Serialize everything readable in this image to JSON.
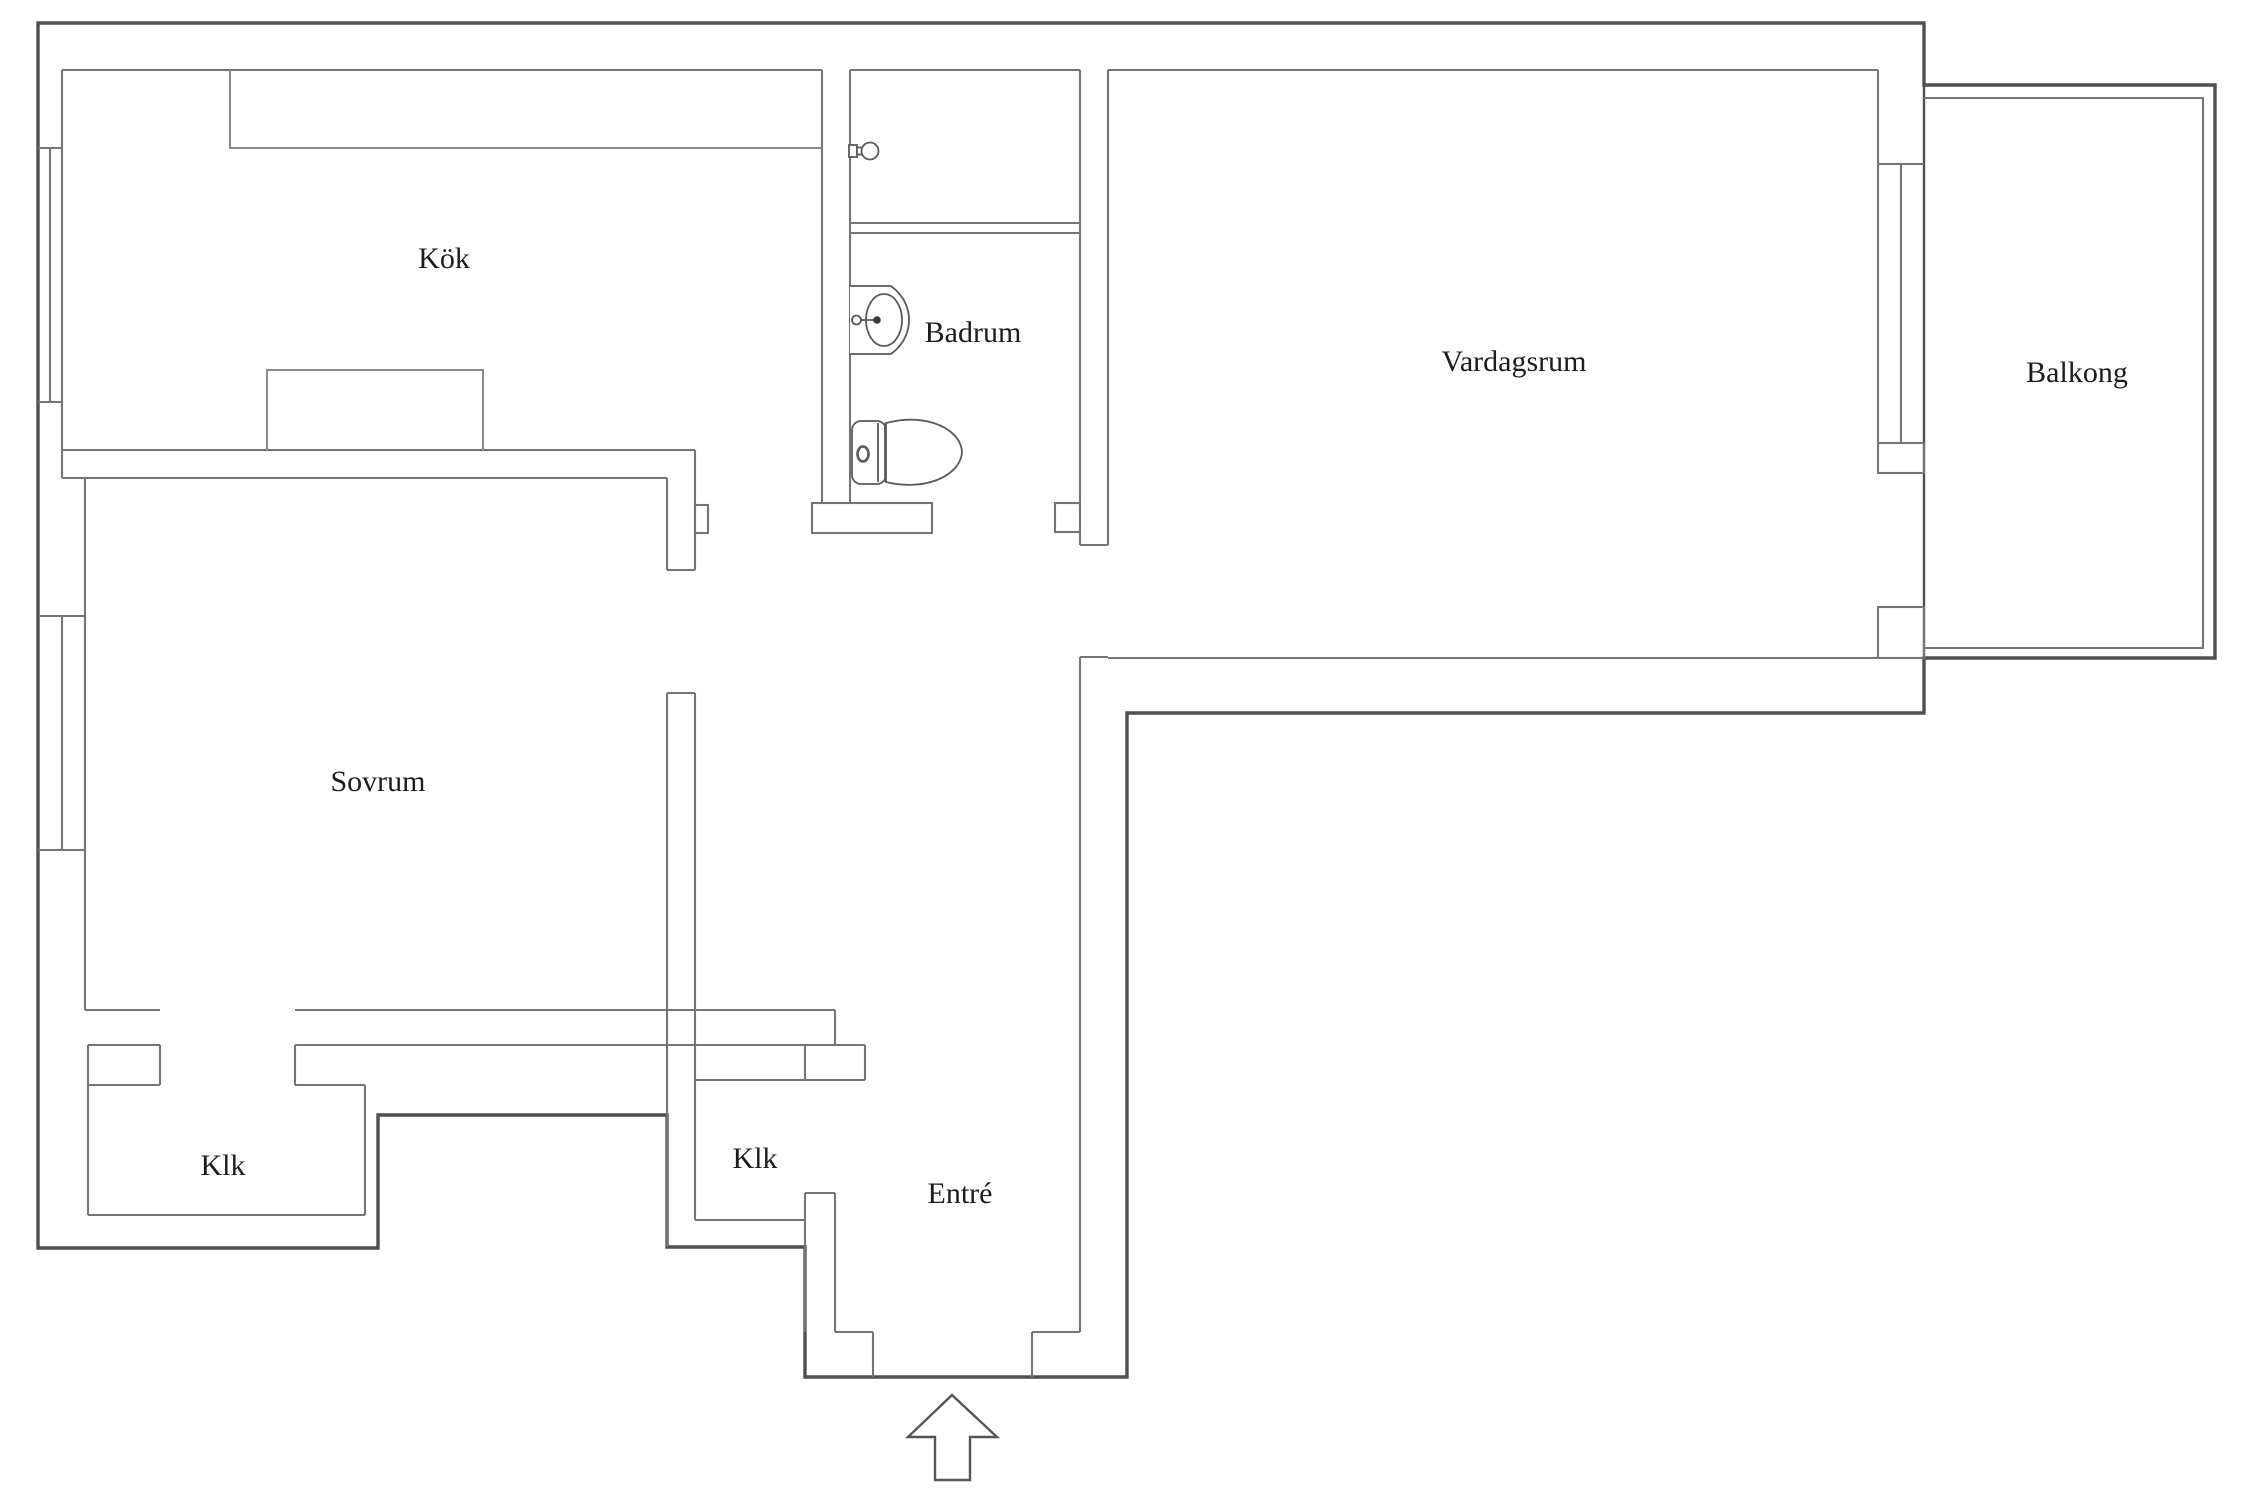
{
  "document": {
    "type": "apartment-floor-plan",
    "language": "Swedish"
  },
  "rooms": [
    {
      "id": "kok",
      "label": "Kök"
    },
    {
      "id": "badrum",
      "label": "Badrum"
    },
    {
      "id": "vardagsrum",
      "label": "Vardagsrum"
    },
    {
      "id": "balkong",
      "label": "Balkong"
    },
    {
      "id": "sovrum",
      "label": "Sovrum"
    },
    {
      "id": "klk-left",
      "label": "Klk"
    },
    {
      "id": "klk-middle",
      "label": "Klk"
    },
    {
      "id": "entre",
      "label": "Entré"
    }
  ],
  "fixtures": [
    {
      "id": "toilet-icon",
      "room": "badrum"
    },
    {
      "id": "sink-icon",
      "room": "badrum"
    },
    {
      "id": "shower-icon",
      "room": "badrum"
    },
    {
      "id": "counter",
      "room": "kok"
    },
    {
      "id": "appliance",
      "room": "kok"
    },
    {
      "id": "entrance-arrow",
      "room": "entre"
    }
  ],
  "colors": {
    "background": "#ffffff",
    "outer_wall": "#4f4f4f",
    "inner_wall": "#757575",
    "fixture_line": "#5a5a5a",
    "label_text": "#1c1c1c"
  }
}
